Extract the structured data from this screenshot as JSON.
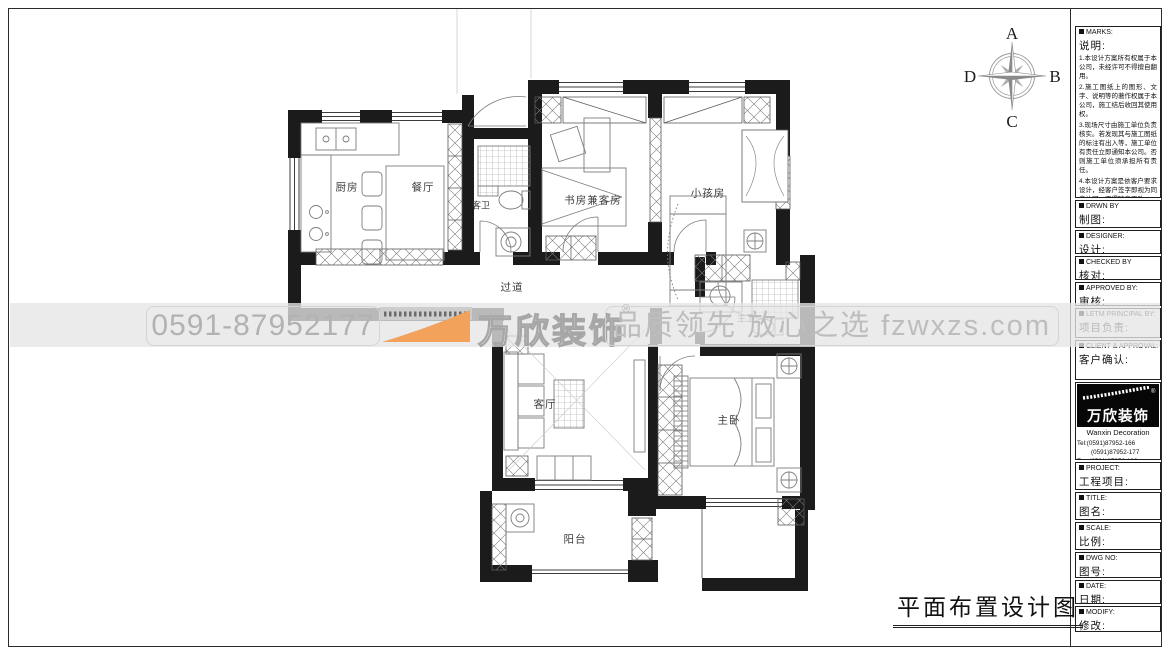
{
  "sheet": {
    "bottom_title": "平面布置设计图"
  },
  "compass": {
    "n": "A",
    "e": "B",
    "s": "C",
    "w": "D"
  },
  "rooms": {
    "kitchen": "厨房",
    "dining": "餐厅",
    "guest_bath": "客卫",
    "study": "书房兼客房",
    "kids": "小孩房",
    "corridor": "过道",
    "master_bath": "主卫",
    "living": "客厅",
    "master": "主卧",
    "balcony": "阳台"
  },
  "watermark": {
    "phone": "0591-87952177",
    "brand": "万欣装饰",
    "reg": "®",
    "slogan": "品质领先 放心之选 fzwxzs.com",
    "accent_orange": "#f3a25c",
    "text_gray": "#bdbdbd"
  },
  "title_block": {
    "marks": {
      "en": "MARKS:",
      "zh": "说明:",
      "notes": [
        "1.本设计方案所有权属于本公司，未经许可不得擅自翻用。",
        "2.施工图纸上的图形、文字、说明等的著作权属于本公司，施工结后收回其使用权。",
        "3.现场尺寸由施工单位负责核实。若发现其与施工图纸的标注有出入等，施工单位有责任立即通知本公司。否则施工单位须承担所有责任。",
        "4.本设计方案是依客户要求设计，经客户签字即视为同意认可，不得随意更改。"
      ]
    },
    "sections": [
      {
        "en": "DRWN BY",
        "zh": "制图:"
      },
      {
        "en": "DESIGNER:",
        "zh": "设计:"
      },
      {
        "en": "CHECKED BY",
        "zh": "核对:"
      },
      {
        "en": "APPROVED BY:",
        "zh": "审核:"
      },
      {
        "en": "LETM PRINCIPAL BY:",
        "zh": "项目负责:"
      },
      {
        "en": "CLIENT & APPROVAL:",
        "zh": "客户确认:"
      }
    ],
    "company": {
      "logo_text": "万欣装饰",
      "logo_sub": "Wanxin Decoration",
      "reg": "®",
      "tel1": "Tel:(0591)87952-166",
      "tel2": "(0591)87952-177",
      "fax": "Fax:(0591)87952-199",
      "web": "Web:WWW.fzwxzs.com"
    },
    "sections2": [
      {
        "en": "PROJECT:",
        "zh": "工程项目:"
      },
      {
        "en": "TITLE:",
        "zh": "图名:"
      },
      {
        "en": "SCALE:",
        "zh": "比例:"
      },
      {
        "en": "DWG NO:",
        "zh": "图号:"
      },
      {
        "en": "DATE:",
        "zh": "日期:"
      },
      {
        "en": "MODIFY:",
        "zh": "修改:"
      }
    ]
  }
}
